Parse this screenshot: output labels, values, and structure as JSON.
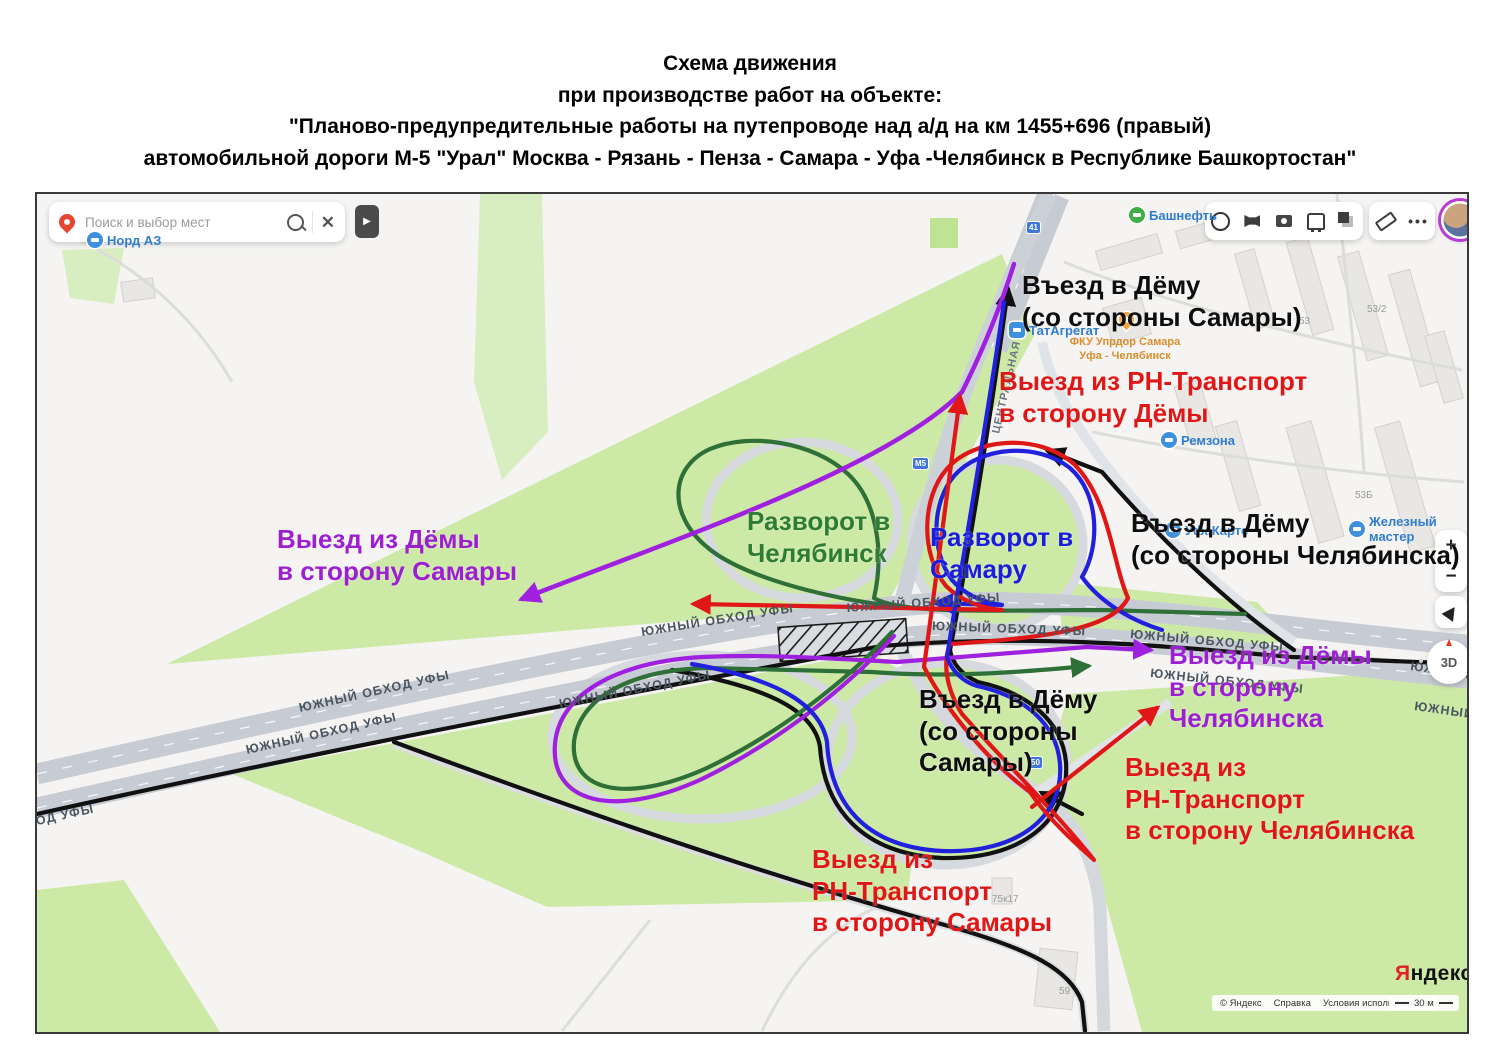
{
  "title": {
    "lines": [
      "Схема движения",
      "при производстве работ на объекте:",
      "\"Планово-предупредительные работы на путепроводе над а/д на км 1455+696 (правый)",
      "автомобильной дороги М-5 \"Урал\" Москва - Рязань - Пенза - Самара - Уфа -Челябинск в Республике Башкортостан\""
    ]
  },
  "map": {
    "search": {
      "placeholder": "Поиск и выбор мест"
    },
    "controls": {
      "zoom_in": "+",
      "zoom_out": "−",
      "compass": "3D"
    },
    "road_label": "ЮЖНЫЙ ОБХОД УФЫ",
    "street_label": "ЦЕНТРАЛЬНАЯ УЛ.",
    "pois": [
      {
        "name": "Норд АЗ"
      },
      {
        "name": "Башнефть"
      },
      {
        "name": "ТатАгрегат"
      },
      {
        "name_line1": "ФКУ Упрдор Самара",
        "name_line2": "Уфа - Челябинск"
      },
      {
        "name": "Ремзона"
      },
      {
        "name": "Железный мастер"
      },
      {
        "name": "УфаКартс"
      }
    ],
    "building_numbers": [
      "53",
      "53/2",
      "53Б",
      "75к17",
      "59"
    ],
    "road_badges": [
      "41",
      "М5",
      "50"
    ],
    "scale": "30 м",
    "attribution": {
      "copyright": "© Яндекс",
      "help": "Справка",
      "terms": "Условия использования"
    },
    "logo": {
      "first_letter": "Я",
      "rest": "ндекс"
    }
  },
  "annotations": [
    {
      "id": "entry-dema-from-samara-top",
      "color_hex": "#0d0d0d",
      "lines": [
        "Въезд в Дёму",
        "(со стороны Самары)"
      ]
    },
    {
      "id": "exit-rn-to-dema",
      "color_hex": "#e01717",
      "lines": [
        "Выезд из РН-Транспорт",
        "в сторону Дёмы"
      ]
    },
    {
      "id": "exit-dema-to-samara",
      "color_hex": "#9c1fd1",
      "lines": [
        "Выезд из Дёмы",
        "в сторону Самары"
      ]
    },
    {
      "id": "uturn-to-chelyabinsk",
      "color_hex": "#2e7d32",
      "lines": [
        "Разворот в",
        "Челябинск"
      ]
    },
    {
      "id": "uturn-to-samara",
      "color_hex": "#1c1cdb",
      "lines": [
        "Разворот в",
        "Самару"
      ]
    },
    {
      "id": "entry-dema-from-chelyabinsk",
      "color_hex": "#0d0d0d",
      "lines": [
        "Въезд в Дёму",
        "(со стороны Челябинска)"
      ]
    },
    {
      "id": "exit-dema-to-chelyabinsk",
      "color_hex": "#9c1fd1",
      "lines": [
        "Выезд из Дёмы",
        "в сторону",
        "Челябинска"
      ]
    },
    {
      "id": "entry-dema-from-samara-center",
      "color_hex": "#0d0d0d",
      "lines": [
        "Въезд в Дёму",
        "(со стороны",
        "Самары)"
      ]
    },
    {
      "id": "exit-rn-to-chelyabinsk",
      "color_hex": "#e01717",
      "lines": [
        "Выезд из",
        "РН-Транспорт",
        "в сторону Челябинска"
      ]
    },
    {
      "id": "exit-rn-to-samara",
      "color_hex": "#e01717",
      "lines": [
        "Выезд из",
        "РН-Транспорт",
        "в сторону Самары"
      ]
    }
  ],
  "colors": {
    "route_purple": "#a020e0",
    "route_red": "#e01717",
    "route_blue": "#2020dd",
    "route_green": "#2f6f38",
    "route_black": "#111111",
    "map_green": "#cde9a6",
    "highway_gray": "#c7ccd4"
  }
}
